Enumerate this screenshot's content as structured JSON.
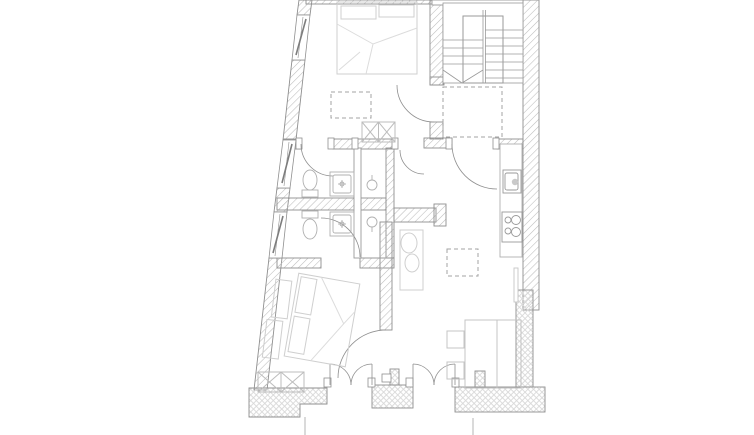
{
  "canvas": {
    "width": 754,
    "height": 435,
    "background": "#ffffff"
  },
  "colors": {
    "wall_outline": "#8f8f8f",
    "wall_hatch": "#bcbcbc",
    "wall_hatch_light": "#d8d8d8",
    "thin_wall": "#9a9a9a",
    "door": "#8f8f8f",
    "furniture": "#cfcfcf",
    "bed_linen": "#dcdcdc",
    "fixture": "#b0b0b0",
    "dashed": "#a3a3a3",
    "stair": "#9a9a9a",
    "window_sash": "#7d7d7d"
  },
  "inventory": {
    "type": "architectural-floor-plan",
    "rooms": [
      "bedroom-upper",
      "hall",
      "stairwell",
      "bathroom-upper",
      "bathroom-lower",
      "shaft-upper",
      "shaft-lower",
      "bedroom-lower",
      "living-dining",
      "kitchen"
    ],
    "window_count": 3,
    "door_swing_count": 10,
    "french_door_openings": 2,
    "dashed_void_count": 3,
    "fixtures": [
      "double-bed",
      "double-bed",
      "toilet",
      "toilet",
      "shower-tray",
      "shower-tray",
      "kitchen-sink",
      "cooktop-4-burner",
      "kitchen-counter",
      "dining-table",
      "chair",
      "chair",
      "wardrobe",
      "bench-x",
      "bench-x",
      "radiator",
      "cabinet",
      "stair-run"
    ]
  }
}
